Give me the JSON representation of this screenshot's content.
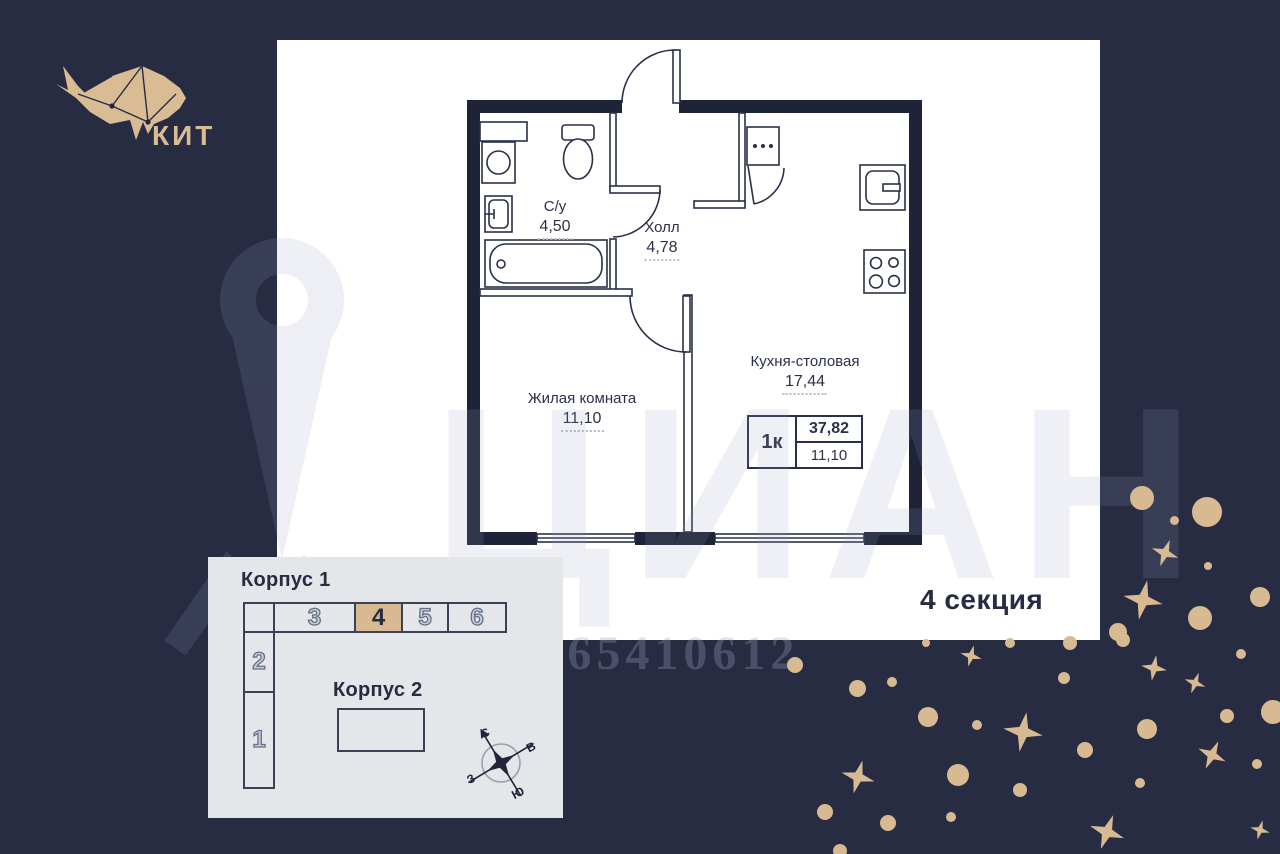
{
  "logo": {
    "brand": "КИТ"
  },
  "plan": {
    "rooms": [
      {
        "name": "С/у",
        "area": "4,50"
      },
      {
        "name": "Холл",
        "area": "4,78"
      },
      {
        "name": "Жилая комната",
        "area": "11,10"
      },
      {
        "name": "Кухня-столовая",
        "area": "17,44"
      }
    ],
    "summary": {
      "rooms_label": "1к",
      "total_area": "37,82",
      "living_area": "11,10"
    },
    "section_label": "4 секция"
  },
  "site_plan": {
    "korpus1": {
      "title": "Корпус 1",
      "row_sections": [
        "3",
        "4",
        "5",
        "6"
      ],
      "col_sections": [
        "2",
        "1"
      ],
      "highlighted": "4"
    },
    "korpus2": {
      "title": "Корпус 2"
    },
    "compass": {
      "n": "С",
      "e": "В",
      "w": "З",
      "s": "Ю"
    }
  },
  "watermark": {
    "brand": "ЦИАН",
    "id_text": "ID 65410612"
  },
  "colors": {
    "background": "#272c42",
    "accent_tan": "#d8ba92",
    "panel": "#ffffff",
    "wall": "#1e2338",
    "ink": "#2b3049",
    "inset_bg": "#e4e6ea",
    "highlight_cell": "#d8b991"
  },
  "decor": {
    "dots": [
      [
        795,
        665,
        16
      ],
      [
        857,
        688,
        17
      ],
      [
        892,
        682,
        10
      ],
      [
        928,
        717,
        20
      ],
      [
        977,
        725,
        10
      ],
      [
        1064,
        678,
        12
      ],
      [
        1085,
        750,
        16
      ],
      [
        1147,
        729,
        20
      ],
      [
        1227,
        716,
        14
      ],
      [
        1241,
        654,
        10
      ],
      [
        1273,
        712,
        24
      ],
      [
        1257,
        764,
        10
      ],
      [
        1140,
        783,
        10
      ],
      [
        1020,
        790,
        14
      ],
      [
        958,
        775,
        22
      ],
      [
        951,
        817,
        10
      ],
      [
        888,
        823,
        16
      ],
      [
        825,
        812,
        16
      ],
      [
        926,
        643,
        8
      ],
      [
        1010,
        643,
        10
      ],
      [
        1070,
        643,
        14
      ],
      [
        1123,
        640,
        14
      ],
      [
        1118,
        632,
        18
      ],
      [
        1200,
        618,
        24
      ],
      [
        1260,
        597,
        20
      ],
      [
        1142,
        498,
        24
      ],
      [
        1207,
        512,
        30
      ],
      [
        1174,
        520,
        9
      ],
      [
        1208,
        566,
        8
      ],
      [
        840,
        851,
        14
      ]
    ],
    "stars": [
      [
        971,
        656,
        22,
        15
      ],
      [
        1154,
        668,
        26,
        10
      ],
      [
        1195,
        683,
        22,
        20
      ],
      [
        1023,
        732,
        40,
        10
      ],
      [
        1212,
        755,
        30,
        25
      ],
      [
        858,
        777,
        34,
        15
      ],
      [
        1107,
        832,
        36,
        20
      ],
      [
        1260,
        830,
        20,
        15
      ],
      [
        1165,
        553,
        28,
        20
      ],
      [
        1143,
        600,
        40,
        12
      ]
    ]
  }
}
